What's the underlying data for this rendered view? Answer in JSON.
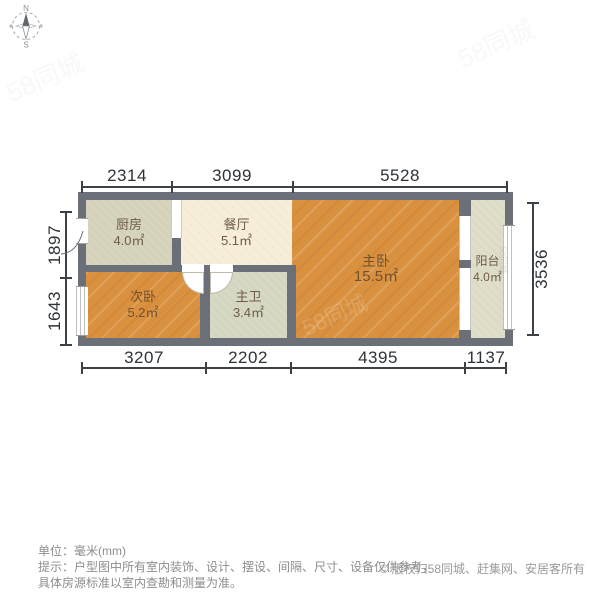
{
  "compass": {
    "north": "N",
    "south": "S"
  },
  "dimensions": {
    "top": [
      "2314",
      "3099",
      "5528"
    ],
    "bottom": [
      "3207",
      "2202",
      "4395",
      "1137"
    ],
    "left": [
      "1897",
      "1643"
    ],
    "right": [
      "3536"
    ]
  },
  "rooms": [
    {
      "name": "厨房",
      "area": "4.0㎡"
    },
    {
      "name": "餐厅",
      "area": "5.1㎡"
    },
    {
      "name": "主卧",
      "area": "15.5㎡"
    },
    {
      "name": "阳台",
      "area": "4.0㎡"
    },
    {
      "name": "次卧",
      "area": "5.2㎡"
    },
    {
      "name": "主卫",
      "area": "3.4㎡"
    }
  ],
  "footer": {
    "unit": "单位：毫米(mm)",
    "tip_line1": "提示：户型图中所有室内装饰、设计、摆设、间隔、尺寸、设备仅供参考，",
    "tip_line2": "具体房源标准以室内查勘和测量为准。",
    "copyright": "© 版权归58同城、赶集网、安居客所有"
  },
  "watermark": {
    "text": "58同城"
  },
  "colors": {
    "wall": "#6b7078",
    "wood_floor": "#d9913f",
    "kitchen_floor": "#d7d4be",
    "dining_floor": "#f6eed9",
    "bath_floor": "#d6d8c3",
    "balcony_floor": "#dfdec9",
    "dimension_text": "#2e3337",
    "footer_text": "#8d8d8d"
  }
}
